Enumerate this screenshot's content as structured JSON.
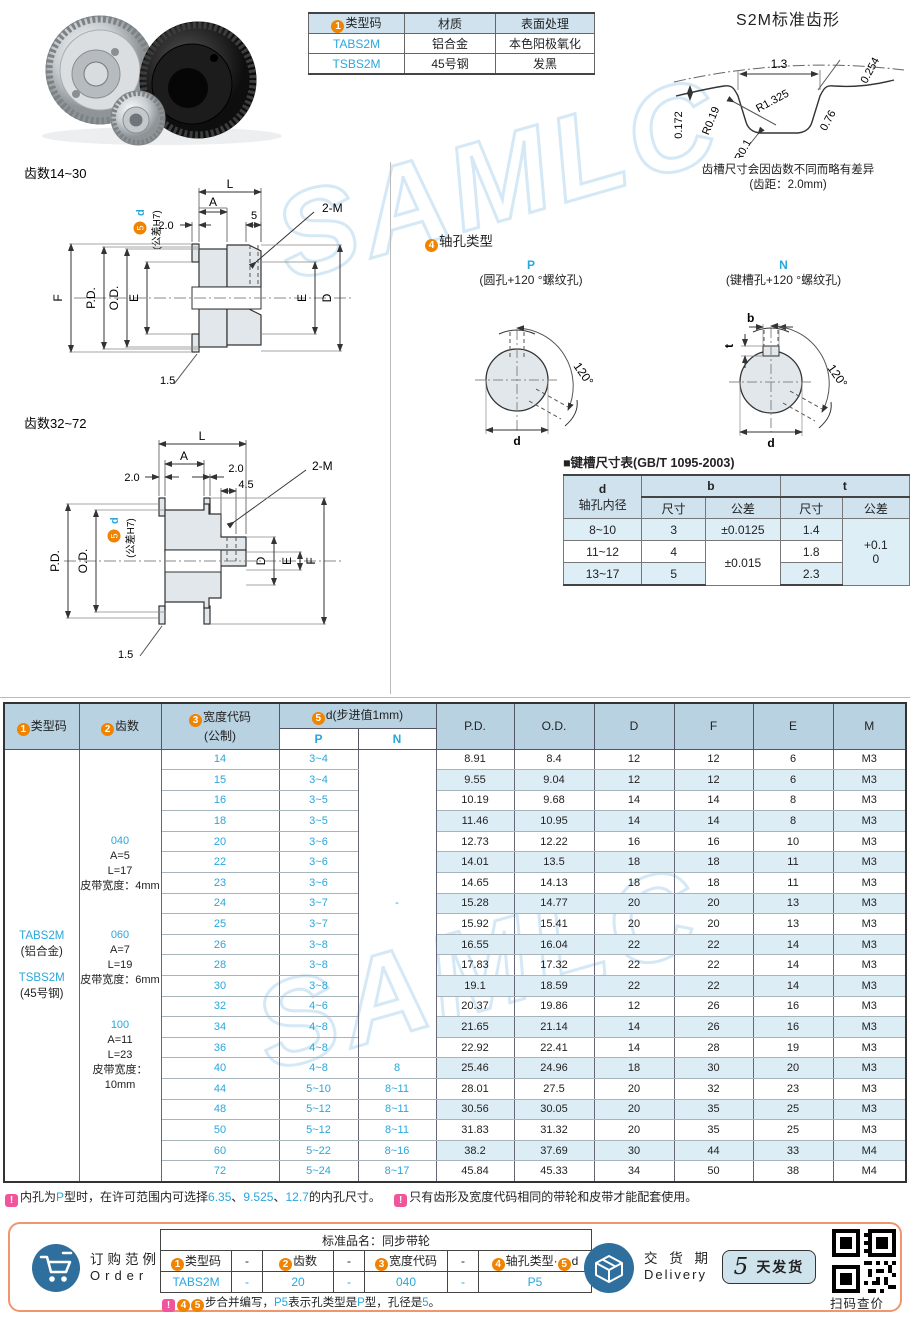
{
  "colors": {
    "link_blue": "#2aa7dc",
    "circle_orange": "#f08300",
    "note_pink": "#f0559b",
    "table_header_bg": "#b9d2e2",
    "band_bg": "#ddedf6",
    "footer_border": "#f0956e",
    "icon_blue": "#2f6f9d"
  },
  "watermark": "SAMLC",
  "spec_table": {
    "header": [
      {
        "num": "1",
        "label": "类型码"
      },
      {
        "label": "材质"
      },
      {
        "label": "表面处理"
      }
    ],
    "rows": [
      [
        "TABS2M",
        "铝合金",
        "本色阳极氧化"
      ],
      [
        "TSBS2M",
        "45号钢",
        "发黑"
      ]
    ]
  },
  "tooth_profile": {
    "title": "S2M标准齿形",
    "dim_13": "1.3",
    "dim_0254": "0.254",
    "dim_r1325": "R1.325",
    "dim_r019": "R0.19",
    "dim_0172": "0.172",
    "dim_076": "0.76",
    "dim_r01": "R0.1",
    "note1": "齿槽尺寸会因齿数不同而略有差异",
    "note2": "(齿距：2.0mm)"
  },
  "drawing_small": {
    "title": "齿数14~30",
    "labels": {
      "L": "L",
      "A": "A",
      "s20": "2.0",
      "s5": "5",
      "screw": "2-M",
      "F": "F",
      "PD": "P.D.",
      "OD": "O.D.",
      "E": "E",
      "E2": "E",
      "D": "D",
      "chamfer": "1.5",
      "dnum": "5",
      "dletter": "d",
      "tol": "(公差H7)"
    }
  },
  "drawing_large": {
    "title": "齿数32~72",
    "labels": {
      "L": "L",
      "A": "A",
      "left20": "2.0",
      "right20": "2.0",
      "s45": "4.5",
      "screw": "2-M",
      "PD": "P.D.",
      "OD": "O.D.",
      "D": "D",
      "E": "E",
      "F": "F",
      "chamfer": "1.5",
      "dnum": "5",
      "dletter": "d",
      "tol": "(公差H7)"
    }
  },
  "shaft_types": {
    "num": "4",
    "title": "轴孔类型",
    "p": {
      "label": "P",
      "desc": "(圆孔+120 °螺纹孔)",
      "angle": "120°",
      "d": "d"
    },
    "n": {
      "label": "N",
      "desc": "(键槽孔+120 °螺纹孔)",
      "angle": "120°",
      "d": "d",
      "b": "b",
      "t": "t"
    }
  },
  "keyway_table": {
    "title": "■键槽尺寸表(GB/T 1095-2003)",
    "h_d": "d",
    "h_d_sub": "轴孔内径",
    "h_b": "b",
    "h_t": "t",
    "h_size": "尺寸",
    "h_tol": "公差",
    "r1": {
      "d": "8~10",
      "b": "3",
      "b_tol": "±0.0125",
      "t": "1.4"
    },
    "r2": {
      "d": "11~12",
      "b": "4",
      "b_tol": "±0.015",
      "t": "1.8"
    },
    "r3": {
      "d": "13~17",
      "b": "5",
      "t": "2.3"
    },
    "t_tol_1": "+0.1",
    "t_tol_2": "0"
  },
  "main_table": {
    "headers": {
      "c1num": "1",
      "c1": "类型码",
      "c2num": "2",
      "c2": "齿数",
      "c3num": "3",
      "c3": "宽度代码",
      "c3b": "(公制)",
      "c5num": "5",
      "c5": "d(步进值1mm)",
      "p": "P",
      "n": "N",
      "pd": "P.D.",
      "od": "O.D.",
      "d": "D",
      "f": "F",
      "e": "E",
      "m": "M"
    },
    "type_codes": [
      {
        "code": "TABS2M",
        "mat": "(铝合金)"
      },
      {
        "code": "TSBS2M",
        "mat": "(45号钢)"
      }
    ],
    "width_codes": [
      {
        "code": "040",
        "a": "A=5",
        "l": "L=17",
        "belt": "皮带宽度：4mm"
      },
      {
        "code": "060",
        "a": "A=7",
        "l": "L=19",
        "belt": "皮带宽度：6mm"
      },
      {
        "code": "100",
        "a": "A=11",
        "l": "L=23",
        "belt": "皮带宽度：10mm"
      }
    ],
    "n_dash": "-",
    "n_merged_rows": 15,
    "rows": [
      [
        "14",
        "3~4",
        "",
        "8.91",
        "8.4",
        "12",
        "12",
        "6",
        "M3"
      ],
      [
        "15",
        "3~4",
        "",
        "9.55",
        "9.04",
        "12",
        "12",
        "6",
        "M3"
      ],
      [
        "16",
        "3~5",
        "",
        "10.19",
        "9.68",
        "14",
        "14",
        "8",
        "M3"
      ],
      [
        "18",
        "3~5",
        "",
        "11.46",
        "10.95",
        "14",
        "14",
        "8",
        "M3"
      ],
      [
        "20",
        "3~6",
        "",
        "12.73",
        "12.22",
        "16",
        "16",
        "10",
        "M3"
      ],
      [
        "22",
        "3~6",
        "",
        "14.01",
        "13.5",
        "18",
        "18",
        "11",
        "M3"
      ],
      [
        "23",
        "3~6",
        "",
        "14.65",
        "14.13",
        "18",
        "18",
        "11",
        "M3"
      ],
      [
        "24",
        "3~7",
        "",
        "15.28",
        "14.77",
        "20",
        "20",
        "13",
        "M3"
      ],
      [
        "25",
        "3~7",
        "",
        "15.92",
        "15.41",
        "20",
        "20",
        "13",
        "M3"
      ],
      [
        "26",
        "3~8",
        "",
        "16.55",
        "16.04",
        "22",
        "22",
        "14",
        "M3"
      ],
      [
        "28",
        "3~8",
        "",
        "17.83",
        "17.32",
        "22",
        "22",
        "14",
        "M3"
      ],
      [
        "30",
        "3~8",
        "",
        "19.1",
        "18.59",
        "22",
        "22",
        "14",
        "M3"
      ],
      [
        "32",
        "4~6",
        "",
        "20.37",
        "19.86",
        "12",
        "26",
        "16",
        "M3"
      ],
      [
        "34",
        "4~8",
        "",
        "21.65",
        "21.14",
        "14",
        "26",
        "16",
        "M3"
      ],
      [
        "36",
        "4~8",
        "",
        "22.92",
        "22.41",
        "14",
        "28",
        "19",
        "M3"
      ],
      [
        "40",
        "4~8",
        "8",
        "25.46",
        "24.96",
        "18",
        "30",
        "20",
        "M3"
      ],
      [
        "44",
        "5~10",
        "8~11",
        "28.01",
        "27.5",
        "20",
        "32",
        "23",
        "M3"
      ],
      [
        "48",
        "5~12",
        "8~11",
        "30.56",
        "30.05",
        "20",
        "35",
        "25",
        "M3"
      ],
      [
        "50",
        "5~12",
        "8~11",
        "31.83",
        "31.32",
        "20",
        "35",
        "25",
        "M3"
      ],
      [
        "60",
        "5~22",
        "8~16",
        "38.2",
        "37.69",
        "30",
        "44",
        "33",
        "M4"
      ],
      [
        "72",
        "5~24",
        "8~17",
        "45.84",
        "45.33",
        "34",
        "50",
        "38",
        "M4"
      ]
    ]
  },
  "notes": {
    "n1a": "内孔为",
    "n1b": "P",
    "n1c": "型时，在许可范围内可选择",
    "n1d": "6.35",
    "n1e": "、",
    "n1f": "9.525",
    "n1g": "、",
    "n1h": "12.7",
    "n1i": "的内孔尺寸。",
    "n2": "只有齿形及宽度代码相同的带轮和皮带才能配套使用。"
  },
  "footer": {
    "order_cn": "订购范例",
    "order_en": "Order",
    "product_name": "标准品名：同步带轮",
    "oh1num": "1",
    "oh1": "类型码",
    "dash": "-",
    "oh2num": "2",
    "oh2": "齿数",
    "oh3num": "3",
    "oh3": "宽度代码",
    "oh4num": "4",
    "oh4": "轴孔类型",
    "ohsep": "·",
    "oh5num": "5",
    "oh5": "d",
    "ov1": "TABS2M",
    "ov2": "-",
    "ov3": "20",
    "ov4": "-",
    "ov5": "040",
    "ov6": "-",
    "ov7": "P5",
    "c4": "4",
    "c5": "5",
    "on1": "步合并编写，",
    "on2": "P5",
    "on3": "表示孔类型是",
    "on4": "P",
    "on5": "型，孔径是",
    "on6": "5",
    "on7": "。",
    "delivery_cn": "交 货 期",
    "delivery_en": "Delivery",
    "days": "5",
    "days_unit": "天发货",
    "qr_caption": "扫码查价"
  }
}
